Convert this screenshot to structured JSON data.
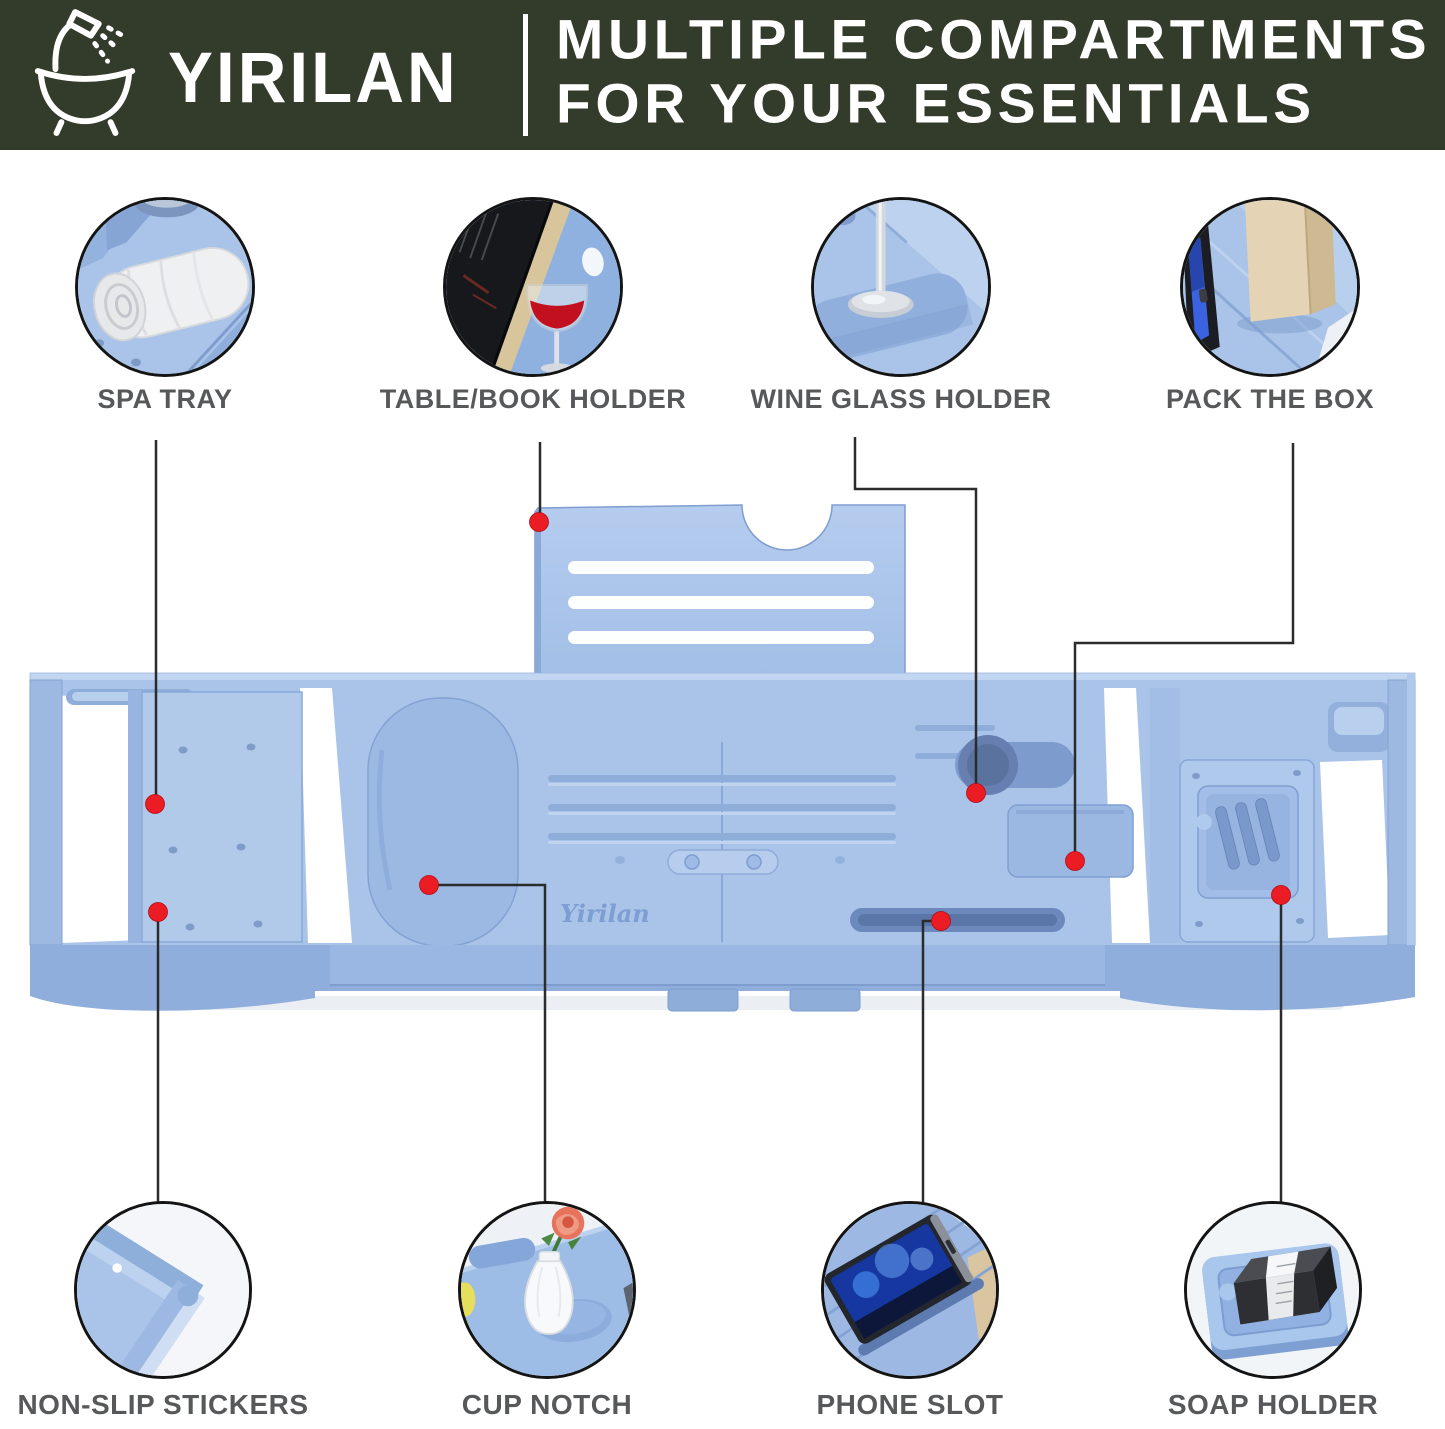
{
  "header": {
    "brand": "YIRILAN",
    "title_line1": "MULTIPLE COMPARTMENTS",
    "title_line2": "FOR YOUR ESSENTIALS",
    "bg_color": "#333B2B",
    "text_color": "#FFFFFF"
  },
  "features_top": [
    {
      "label": "SPA TRAY"
    },
    {
      "label": "TABLE/BOOK HOLDER"
    },
    {
      "label": "WINE GLASS HOLDER"
    },
    {
      "label": "PACK THE BOX"
    }
  ],
  "features_bottom": [
    {
      "label": "NON-SLIP STICKERS"
    },
    {
      "label": "CUP NOTCH"
    },
    {
      "label": "PHONE SLOT"
    },
    {
      "label": "SOAP HOLDER"
    }
  ],
  "product": {
    "embossed_logo": "Yirilan",
    "tray_color": "#A9C4E8",
    "callout_dot_color": "#EC1C24",
    "connector_line_color": "#2B2B2B",
    "label_color": "#57585A"
  }
}
